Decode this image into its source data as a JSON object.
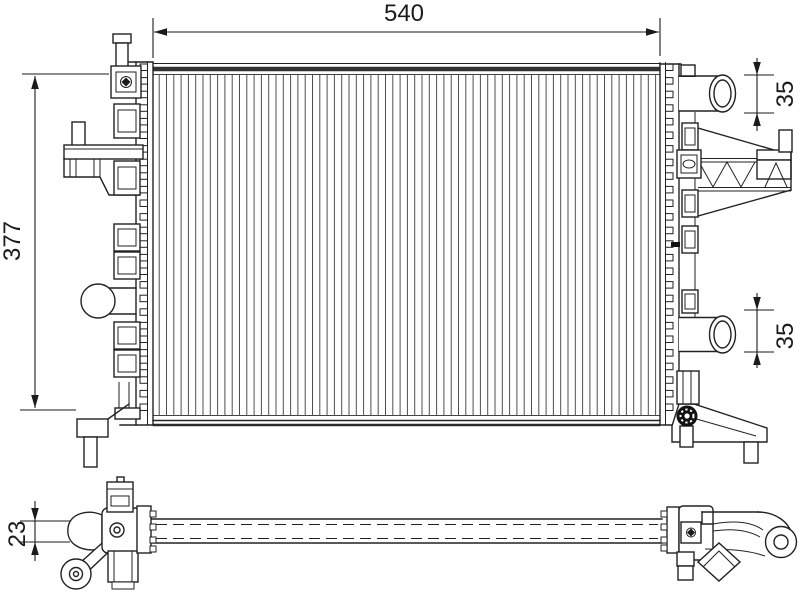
{
  "drawing": {
    "type": "technical-line-drawing",
    "subject": "automotive radiator - front view and bottom view",
    "colors": {
      "background": "#ffffff",
      "line": "#222222",
      "fin_line": "#4f4f4f",
      "dark_fill": "#111111"
    },
    "dimensions": {
      "core_width": "540",
      "overall_height": "377",
      "top_port_diameter": "35",
      "bottom_port_diameter": "35",
      "core_depth": "23"
    }
  }
}
